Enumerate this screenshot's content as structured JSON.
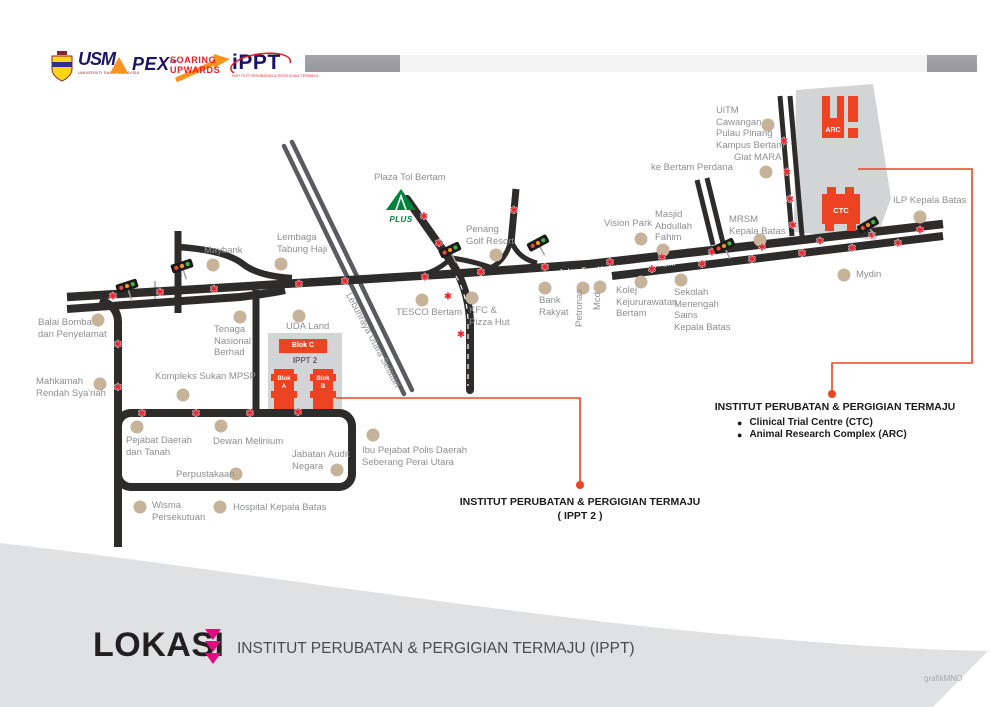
{
  "header": {
    "usm": {
      "mark": "USM",
      "caption": "UNIVERSITI SAINS MALAYSIA"
    },
    "apex": {
      "mark": "PEX",
      "tm": "TM"
    },
    "soaring": {
      "line1": "SOARING",
      "line2": "UPWARDS"
    },
    "ippt_logo": {
      "mark": "iPPT",
      "caption": "INSTITUT PERUBATAN & PERGIGIAN TERMAJU"
    }
  },
  "map": {
    "road_label_main": "Jalan Tun Hamdan Sheikh Tahir",
    "road_label_highway": "Lebuhraya Utara Selatan",
    "plus_logo_label": "PLUS",
    "campus": {
      "arc": "ARC",
      "ctc": "CTC",
      "blok_c": "Blok C",
      "ippt2": "IPPT 2",
      "blok_a": "Blok\nA",
      "blok_b": "Blok\nB"
    },
    "places": [
      {
        "label": "Plaza Tol Bertam",
        "x": 374,
        "y": 172
      },
      {
        "label": "Maybank",
        "x": 204,
        "y": 245,
        "dot": [
          213,
          265
        ]
      },
      {
        "label": "Lembaga\nTabung Haji",
        "x": 277,
        "y": 232,
        "dot": [
          281,
          264
        ]
      },
      {
        "label": "Balai Bomba\ndan Penyelamat",
        "x": 38,
        "y": 317,
        "dot": [
          98,
          320
        ]
      },
      {
        "label": "Mahkamah\nRendah Sya'riah",
        "x": 36,
        "y": 376,
        "dot": [
          100,
          384
        ]
      },
      {
        "label": "Tenaga\nNasional\nBerhad",
        "x": 214,
        "y": 324,
        "dot": [
          240,
          317
        ]
      },
      {
        "label": "UDA Land",
        "x": 286,
        "y": 321,
        "dot": [
          299,
          316
        ]
      },
      {
        "label": "Kompleks Sukan MPSP",
        "x": 155,
        "y": 371,
        "dot": [
          183,
          395
        ]
      },
      {
        "label": "Pejabat Daerah\ndan Tanah",
        "x": 126,
        "y": 435,
        "dot": [
          137,
          427
        ]
      },
      {
        "label": "Dewan Melinium",
        "x": 213,
        "y": 436,
        "dot": [
          221,
          426
        ]
      },
      {
        "label": "Perpustakaan",
        "x": 176,
        "y": 469,
        "dot": [
          236,
          474
        ]
      },
      {
        "label": "Jabatan Audit\nNegara",
        "x": 292,
        "y": 449,
        "dot": [
          337,
          470
        ]
      },
      {
        "label": "Ibu Pejabat Polis Daerah\nSeberang Perai Utara",
        "x": 362,
        "y": 445,
        "dot": [
          373,
          435
        ]
      },
      {
        "label": "Wisma\nPersekutuan",
        "x": 152,
        "y": 500,
        "dot": [
          140,
          507
        ]
      },
      {
        "label": "Hospital Kepala Batas",
        "x": 233,
        "y": 502,
        "dot": [
          220,
          507
        ]
      },
      {
        "label": "TESCO Bertam",
        "x": 396,
        "y": 307,
        "dot": [
          422,
          300
        ]
      },
      {
        "label": "KFC &\nPizza Hut",
        "x": 469,
        "y": 305,
        "dot": [
          472,
          298
        ]
      },
      {
        "label": "Penang\nGolf Resort",
        "x": 466,
        "y": 224,
        "dot": [
          496,
          255
        ]
      },
      {
        "label": "Bank\nRakyat",
        "x": 539,
        "y": 295,
        "dot": [
          545,
          288
        ]
      },
      {
        "label": "Petronas",
        "x": 574,
        "y": 327,
        "rot": -90,
        "dot": [
          583,
          288
        ]
      },
      {
        "label": "Mcd",
        "x": 592,
        "y": 310,
        "rot": -90,
        "dot": [
          600,
          287
        ]
      },
      {
        "label": "Kolej\nKejururawatan\nBertam",
        "x": 616,
        "y": 285,
        "dot": [
          641,
          282
        ]
      },
      {
        "label": "Sekolah\nMenengah\nSains\nKepala Batas",
        "x": 674,
        "y": 287,
        "dot": [
          681,
          280
        ]
      },
      {
        "label": "Vision Park",
        "x": 604,
        "y": 218,
        "dot": [
          641,
          239
        ]
      },
      {
        "label": "Masjid\nAbdullah\nFahim",
        "x": 655,
        "y": 209,
        "dot": [
          663,
          250
        ]
      },
      {
        "label": "MRSM\nKepala Batas",
        "x": 729,
        "y": 214,
        "dot": [
          760,
          240
        ]
      },
      {
        "label": "Giat MARA",
        "x": 734,
        "y": 152,
        "dot": [
          766,
          172
        ]
      },
      {
        "label": "ke Bertam Perdana",
        "x": 651,
        "y": 162
      },
      {
        "label": "UiTM\nCawangan\nPulau Pinang\nKampus Bertam",
        "x": 716,
        "y": 105,
        "dot": [
          768,
          125
        ]
      },
      {
        "label": "ILP Kepala Batas",
        "x": 893,
        "y": 195,
        "dot": [
          920,
          217
        ]
      },
      {
        "label": "Mydin",
        "x": 856,
        "y": 269,
        "dot": [
          844,
          275
        ]
      }
    ],
    "markers": [
      [
        113,
        296
      ],
      [
        160,
        292
      ],
      [
        214,
        289
      ],
      [
        299,
        284
      ],
      [
        345,
        281
      ],
      [
        425,
        277
      ],
      [
        481,
        272
      ],
      [
        545,
        267
      ],
      [
        610,
        262
      ],
      [
        662,
        257
      ],
      [
        712,
        252
      ],
      [
        762,
        247
      ],
      [
        820,
        241
      ],
      [
        872,
        235
      ],
      [
        920,
        230
      ],
      [
        652,
        269
      ],
      [
        702,
        264
      ],
      [
        752,
        259
      ],
      [
        802,
        253
      ],
      [
        852,
        248
      ],
      [
        898,
        243
      ],
      [
        118,
        344
      ],
      [
        118,
        387
      ],
      [
        142,
        413
      ],
      [
        196,
        413
      ],
      [
        250,
        413
      ],
      [
        298,
        412
      ],
      [
        424,
        216
      ],
      [
        439,
        243
      ],
      [
        448,
        296
      ],
      [
        461,
        334
      ],
      [
        784,
        141
      ],
      [
        787,
        172
      ],
      [
        790,
        199
      ],
      [
        793,
        225
      ],
      [
        514,
        210
      ]
    ],
    "traffic_lights": [
      [
        127,
        286,
        -18
      ],
      [
        182,
        266,
        -18
      ],
      [
        450,
        250,
        -25
      ],
      [
        538,
        243,
        -28
      ],
      [
        724,
        246,
        -25
      ],
      [
        868,
        225,
        -30
      ]
    ],
    "callouts": {
      "ctc_arc": {
        "title": "INSTITUT PERUBATAN & PERGIGIAN TERMAJU",
        "bullets": [
          "Clinical Trial Centre (CTC)",
          "Animal Research Complex (ARC)"
        ]
      },
      "ippt2": {
        "title": "INSTITUT PERUBATAN & PERGIGIAN TERMAJU",
        "subtitle": "( IPPT 2 )"
      }
    }
  },
  "footer": {
    "title": "LOKASI",
    "subtitle": "INSTITUT PERUBATAN & PERGIGIAN TERMAJU (IPPT)",
    "credit": "grafikMNO"
  },
  "colors": {
    "road": "#2e2c2b",
    "highway": "#5a5b5e",
    "dot": "#c6b39a",
    "marker": "#e8212d",
    "orange": "#ee4323",
    "campus": "#d3d4d6",
    "band": "#e0e1e2",
    "label": "#8d8f92",
    "magenta": "#e5097f",
    "navy": "#1b1464",
    "red": "#ed1c24",
    "accent_orange": "#f7941d",
    "green": "#00843d",
    "bar_dark": "#96989b",
    "bar_light": "#f3f3f4",
    "ink": "#231f20"
  }
}
